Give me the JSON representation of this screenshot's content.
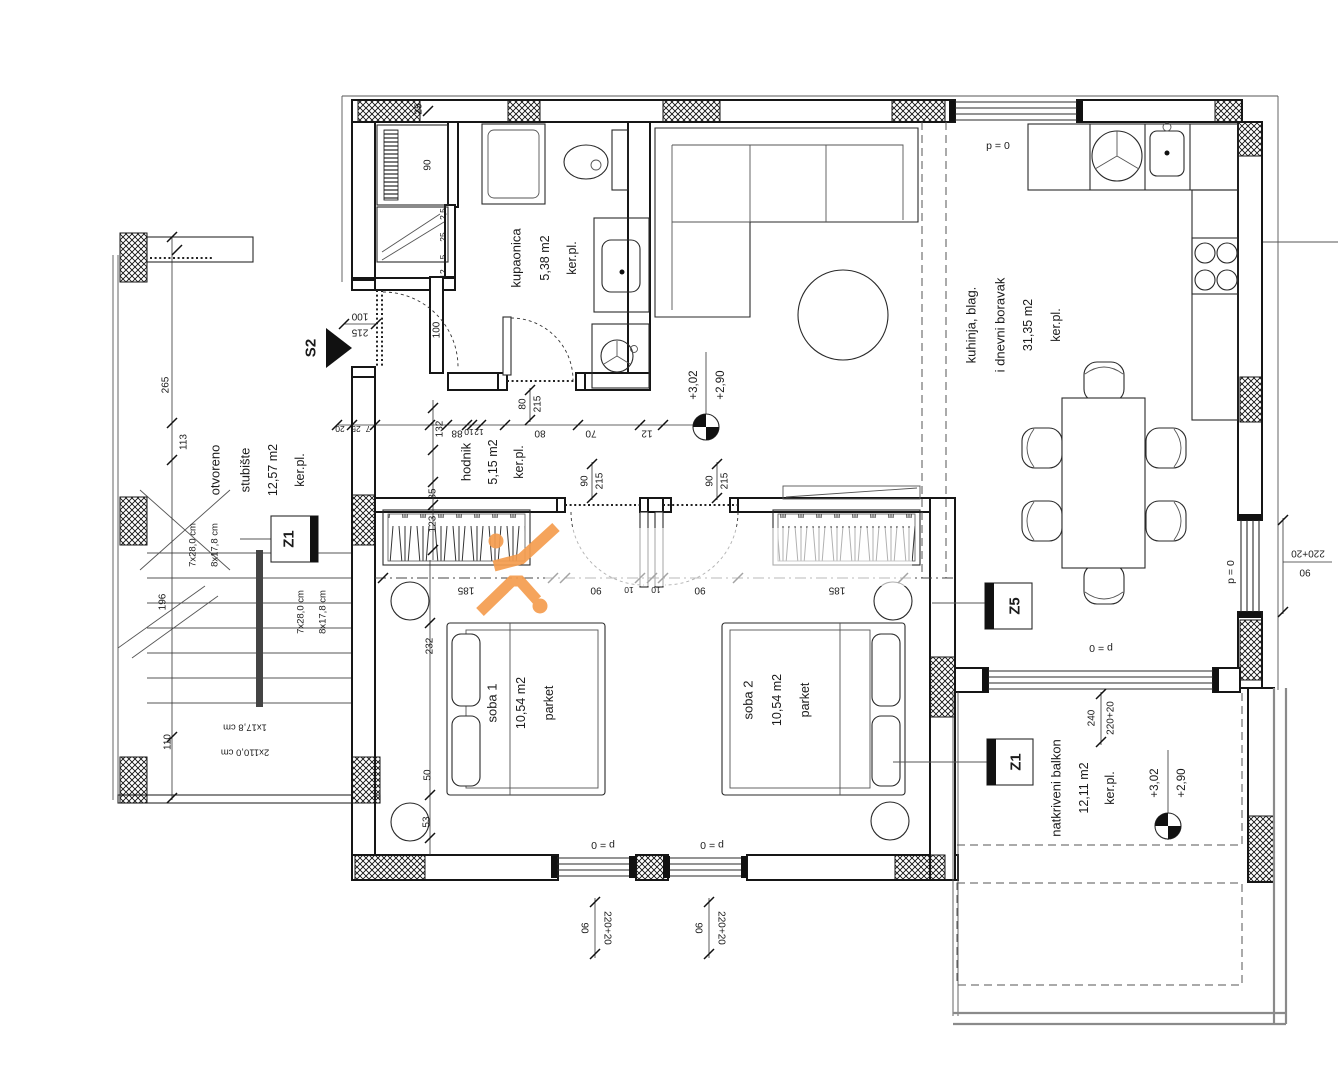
{
  "rooms": {
    "staircase": {
      "name1": "otvoreno",
      "name2": "stubište",
      "area": "12,57 m2",
      "floor": "ker.pl."
    },
    "bathroom": {
      "name": "kupaonica",
      "area": "5,38 m2",
      "floor": "ker.pl."
    },
    "hallway": {
      "name": "hodnik",
      "area": "5,15 m2",
      "floor": "ker.pl."
    },
    "living": {
      "name1": "kuhinja, blag.",
      "name2": "i dnevni boravak",
      "area": "31,35 m2",
      "floor": "ker.pl."
    },
    "room1": {
      "name": "soba 1",
      "area": "10,54 m2",
      "floor": "parket"
    },
    "room2": {
      "name": "soba 2",
      "area": "10,54 m2",
      "floor": "parket"
    },
    "balcony": {
      "name": "natkriveni balkon",
      "area": "12,11 m2",
      "floor": "ker.pl."
    }
  },
  "markers": {
    "section": "S2",
    "z1_stairs": "Z1",
    "z5": "Z5",
    "z1_balcony": "Z1"
  },
  "levels": {
    "upper": "+3,02",
    "lower": "+2,90"
  },
  "parapet": {
    "label": "p = 0"
  },
  "stairs_info": {
    "flight1_run": "7x28,0 cm",
    "flight1_rise": "8x17,8 cm",
    "flight2_run": "7x28,0 cm",
    "flight2_rise": "8x17,8 cm",
    "landing_rise": "1x17,8 cm",
    "landing_size": "2x110,0 cm"
  },
  "dims": {
    "left_chain": {
      "a": "265",
      "b": "113",
      "c": "196",
      "d": "110"
    },
    "v_chain": {
      "wall": "25",
      "closet": "90",
      "n1": "2,5",
      "n2": "25",
      "n3": "5",
      "n4": "12",
      "entry": "100",
      "hall": "132",
      "s35": "35",
      "s123": "123",
      "bed": "232",
      "s50": "50",
      "s53": "53"
    },
    "top_chain": {
      "a": "20",
      "b": "25",
      "c": "7",
      "d": "88",
      "e": "10",
      "f": "12",
      "g": "80",
      "h": "70",
      "i": "12"
    },
    "entry_door": {
      "w": "100",
      "h": "215"
    },
    "bath_door": {
      "w": "80",
      "h": "215"
    },
    "room1_door": {
      "w": "90",
      "h": "215"
    },
    "room2_door": {
      "w": "90",
      "h": "215"
    },
    "mid_chain": {
      "a": "185",
      "b": "90",
      "c": "10",
      "d": "10",
      "e": "90",
      "f": "185"
    },
    "win1": {
      "w": "90",
      "h": "220+20"
    },
    "win2": {
      "w": "90",
      "h": "220+20"
    },
    "balcony_door": {
      "w": "240",
      "h": "220+20"
    },
    "right_win": {
      "h": "220+20",
      "w": "90"
    }
  },
  "watermark": {
    "accent": "#F59D4F"
  }
}
